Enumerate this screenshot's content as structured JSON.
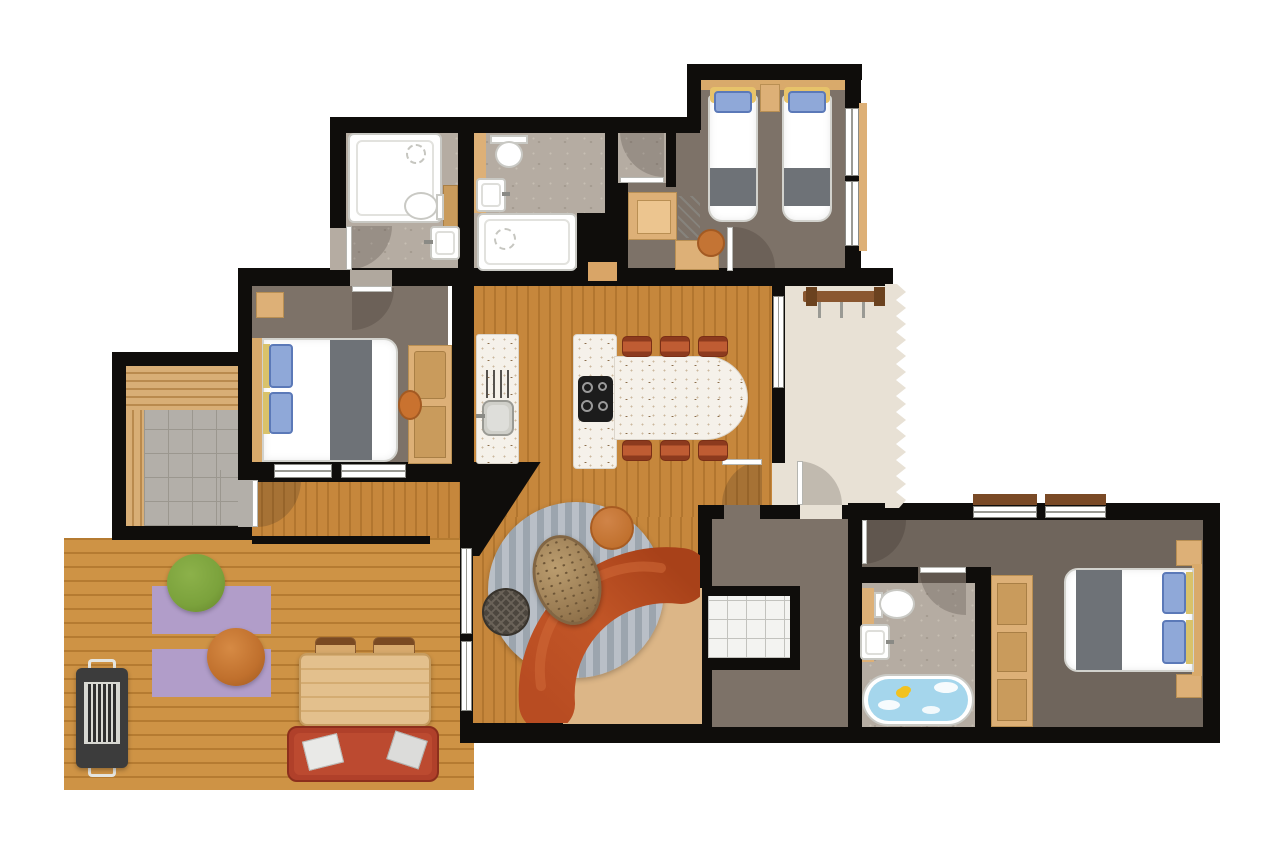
{
  "title": "apartment-floor-plan",
  "colors": {
    "wall": "#0f0d0b",
    "floor_wood": "#c6873c",
    "floor_wood_dark": "#b2762f",
    "deck_wood": "#ce9345",
    "deck_wood_dark": "#b57b31",
    "floor_taupe": "#7d7268",
    "floor_taupe_dark": "#6f655c",
    "floor_stone": "#b5aca2",
    "floor_tile": "#b3afa9",
    "floor_entry": "#e8e1d5",
    "counter_white": "#f5f1ea",
    "furn_tan": "#ddb077",
    "furn_tan_dark": "#c99b5c",
    "headboard_tan": "#d9aa6b",
    "sofa_terracotta_light": "#c25627",
    "sofa_terracotta_dark": "#9e3c1a",
    "chair_terracotta": "#b5532e",
    "mat_tan": "#dcb687",
    "rug_purple": "#b19dc9",
    "pouf_green": "#7ba23c",
    "pouf_orange": "#c0702d",
    "pillow_blue": "#8fa8d8",
    "blanket_grey": "#6e7277",
    "water_blue": "#a5d6ec",
    "duck_yellow": "#f2c21e",
    "bbq_grey": "#3c3c3c",
    "bench_red": "#b0402a",
    "rug_stripe_a": "#b9bfc7",
    "rug_stripe_b": "#9ca5ae"
  },
  "rooms": [
    {
      "name": "bathroom-1",
      "floor": "stone",
      "furniture": [
        "bathtub",
        "toilet",
        "washbasin",
        "vanity-cabinet"
      ]
    },
    {
      "name": "bathroom-2",
      "floor": "stone",
      "furniture": [
        "toilet",
        "washbasin",
        "bathtub",
        "shower-nook"
      ]
    },
    {
      "name": "twin-bedroom",
      "floor": "taupe",
      "furniture": [
        "single-bed",
        "single-bed",
        "nightstand",
        "desk-wardrobe",
        "chair"
      ]
    },
    {
      "name": "double-bedroom-1",
      "floor": "taupe",
      "furniture": [
        "double-bed",
        "nightstand",
        "wardrobe",
        "chair"
      ]
    },
    {
      "name": "sauna",
      "floor": "tile",
      "furniture": [
        "wood-benches"
      ]
    },
    {
      "name": "kitchen-dining",
      "floor": "wood",
      "furniture": [
        "kitchen-counter",
        "sink",
        "dish-rack",
        "island",
        "cooktop",
        "dining-table",
        "chair",
        "chair",
        "chair",
        "chair",
        "chair",
        "chair"
      ]
    },
    {
      "name": "entry-hall",
      "floor": "beige",
      "furniture": [
        "coat-rack"
      ]
    },
    {
      "name": "living-area",
      "floor": "wood",
      "furniture": [
        "curved-sofa",
        "round-rug",
        "stone-coffee-table",
        "dark-pouf",
        "orange-pouf",
        "floor-mat"
      ]
    },
    {
      "name": "hallway",
      "floor": "taupe",
      "furniture": [
        "storage-closet"
      ]
    },
    {
      "name": "double-bedroom-2",
      "floor": "taupe",
      "furniture": [
        "double-bed",
        "nightstand",
        "nightstand",
        "shelf-wardrobe"
      ]
    },
    {
      "name": "bathroom-3",
      "floor": "stone",
      "furniture": [
        "toilet",
        "washbasin",
        "bathtub-with-water",
        "rubber-duck"
      ]
    },
    {
      "name": "deck-terrace",
      "floor": "deck-wood",
      "furniture": [
        "bbq-grill",
        "rug",
        "rug",
        "green-bean-bag",
        "orange-bean-bag",
        "outdoor-table",
        "chair",
        "chair",
        "outdoor-bench",
        "cushion",
        "cushion"
      ]
    }
  ]
}
